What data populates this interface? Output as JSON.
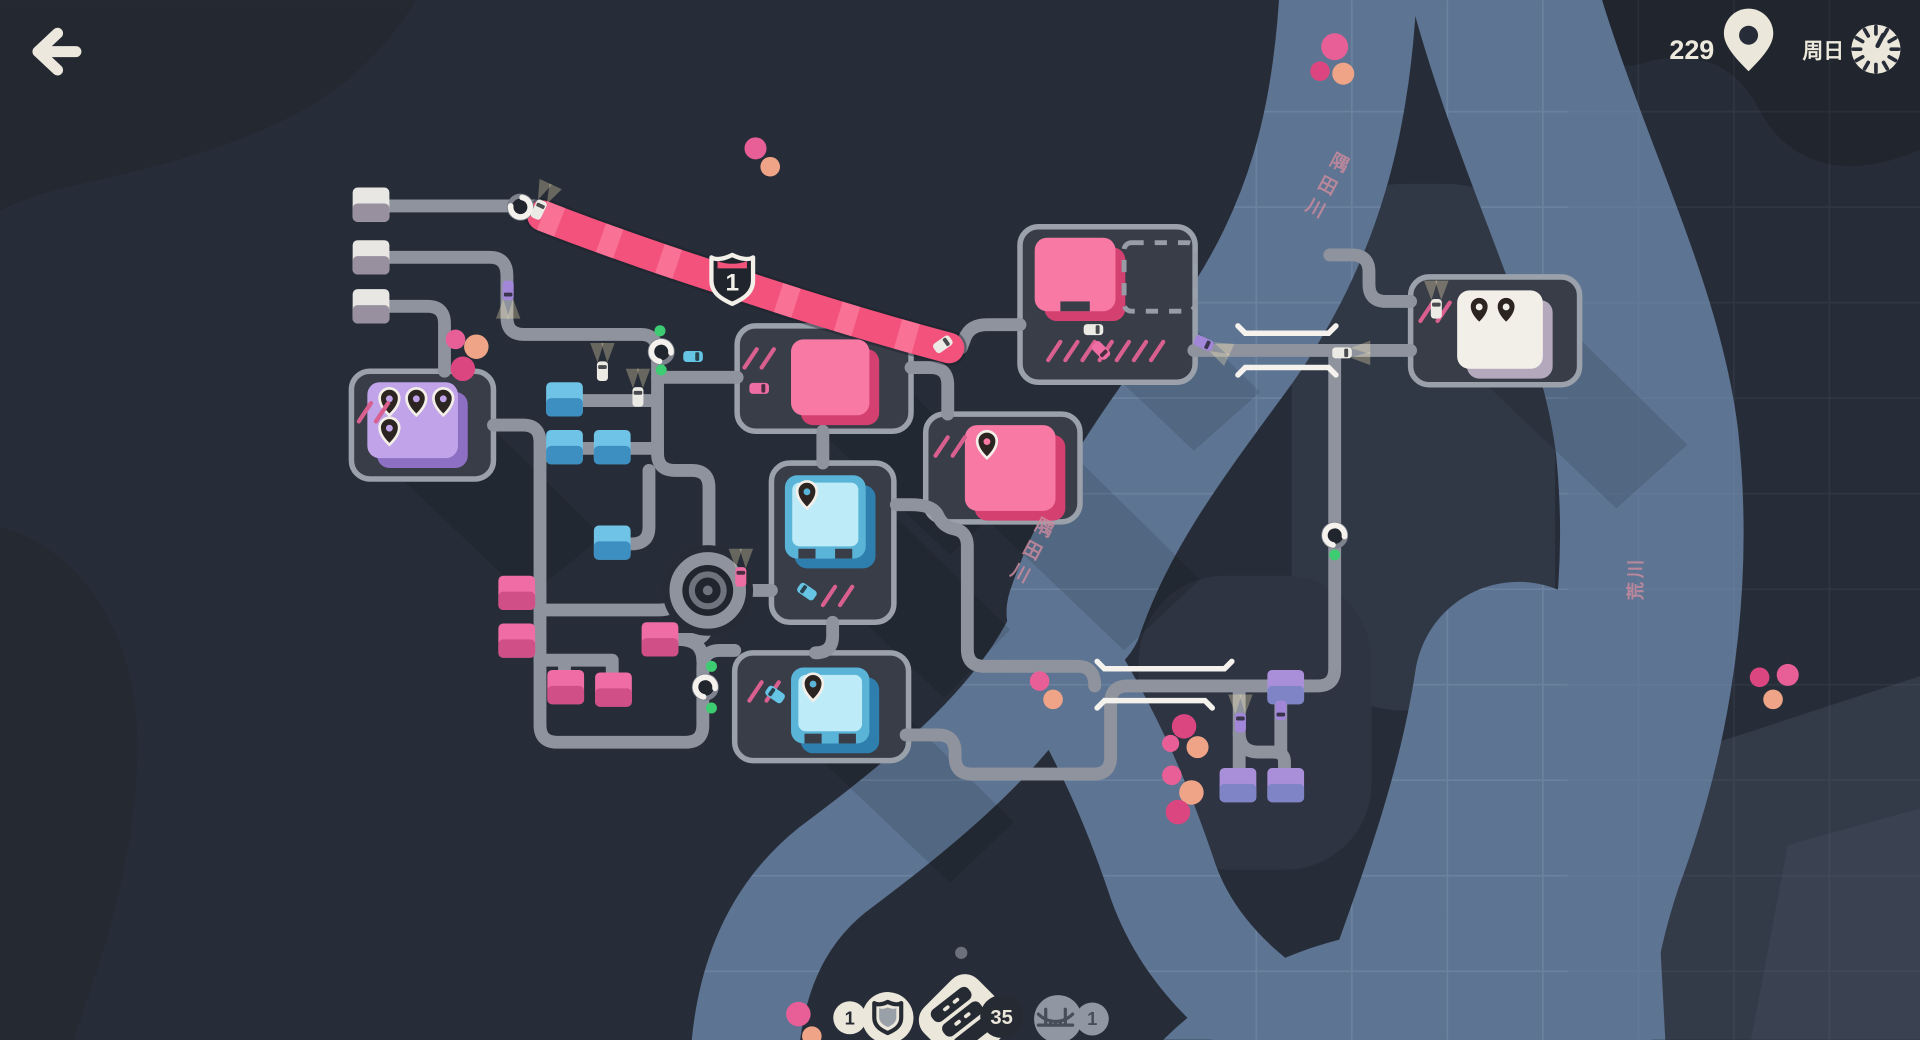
{
  "hud": {
    "back_label": "back",
    "score": "229",
    "day_label": "周日",
    "resources": {
      "motorways": {
        "count": "1",
        "icon": "motorway-shield-icon"
      },
      "road_tiles": {
        "count": "35",
        "icon": "road-tile-stack-icon"
      },
      "bridges": {
        "count": "1",
        "icon": "bridge-icon",
        "state": "disabled"
      }
    }
  },
  "map": {
    "motorway_badge": {
      "number": "1"
    },
    "river_labels": [
      {
        "text": "隅田川",
        "x": 1093,
        "y": 138,
        "rot": 28
      },
      {
        "text": "隅田川",
        "x": 852,
        "y": 436,
        "rot": 28
      },
      {
        "text": "荒川",
        "x": 1341,
        "y": 472,
        "rot": -90
      }
    ],
    "colors": {
      "road": "#8e939d",
      "pad": "#383d48",
      "pad_border": "#9aa1ab",
      "river": "#5d7492",
      "motorway": "#f2527c",
      "cream": "#ece8dc",
      "green_light": "#3ecc72"
    },
    "houses": [
      {
        "color": "white",
        "x": 288,
        "y": 153
      },
      {
        "color": "white",
        "x": 288,
        "y": 196
      },
      {
        "color": "white",
        "x": 288,
        "y": 236
      },
      {
        "color": "cyan",
        "x": 446,
        "y": 312
      },
      {
        "color": "cyan",
        "x": 446,
        "y": 351
      },
      {
        "color": "cyan",
        "x": 485,
        "y": 351
      },
      {
        "color": "cyan",
        "x": 485,
        "y": 429
      },
      {
        "color": "pink",
        "x": 407,
        "y": 470
      },
      {
        "color": "pink",
        "x": 407,
        "y": 509
      },
      {
        "color": "pink",
        "x": 447,
        "y": 547
      },
      {
        "color": "pink",
        "x": 486,
        "y": 549
      },
      {
        "color": "pink",
        "x": 524,
        "y": 508
      },
      {
        "color": "purple",
        "x": 1035,
        "y": 547
      },
      {
        "color": "purple",
        "x": 996,
        "y": 627
      },
      {
        "color": "purple",
        "x": 1035,
        "y": 627
      }
    ],
    "destinations": [
      {
        "color": "purple",
        "x": 300,
        "y": 312,
        "w": 74,
        "h": 62,
        "pins": 4,
        "pad": [
          287,
          303,
          116,
          88
        ],
        "slashes": [
          293,
          344,
          2
        ]
      },
      {
        "color": "pink",
        "x": 845,
        "y": 194,
        "w": 66,
        "h": 60,
        "pins": 0,
        "pad": [
          833,
          185,
          143,
          127
        ],
        "door": 1,
        "dashed": [
          918,
          198,
          58,
          56
        ],
        "slashes": [
          856,
          294,
          7
        ]
      },
      {
        "color": "pink",
        "x": 646,
        "y": 277,
        "w": 64,
        "h": 62,
        "pins": 0,
        "pad": [
          602,
          266,
          142,
          86
        ],
        "slashes": [
          608,
          300,
          2
        ]
      },
      {
        "color": "pink",
        "x": 788,
        "y": 347,
        "w": 74,
        "h": 70,
        "pins": 1,
        "pad": [
          756,
          338,
          126,
          88
        ],
        "slashes": [
          764,
          372,
          2
        ]
      },
      {
        "color": "cyan",
        "x": 641,
        "y": 388,
        "w": 66,
        "h": 68,
        "pins": 1,
        "pad": [
          630,
          378,
          100,
          130
        ],
        "door": 2,
        "slashes": [
          672,
          494,
          2
        ]
      },
      {
        "color": "cyan",
        "x": 646,
        "y": 545,
        "w": 64,
        "h": 62,
        "pins": 1,
        "pad": [
          600,
          533,
          142,
          88
        ],
        "door": 2,
        "slashes": [
          612,
          572,
          2
        ]
      },
      {
        "color": "white",
        "x": 1190,
        "y": 237,
        "w": 70,
        "h": 64,
        "pins": 2,
        "pad": [
          1152,
          226,
          138,
          88
        ],
        "slashes": [
          1160,
          262,
          2
        ]
      }
    ],
    "cars": [
      {
        "color": "white",
        "x": 440,
        "y": 171,
        "rot": 25,
        "lights": true
      },
      {
        "color": "purple",
        "x": 415,
        "y": 237,
        "rot": 180,
        "lights": true
      },
      {
        "color": "cyan",
        "x": 566,
        "y": 291,
        "rot": 90
      },
      {
        "color": "white",
        "x": 492,
        "y": 303,
        "rot": 0,
        "lights": true
      },
      {
        "color": "white",
        "x": 521,
        "y": 324,
        "rot": 0,
        "lights": true
      },
      {
        "color": "white",
        "x": 893,
        "y": 269,
        "rot": 90
      },
      {
        "color": "pink",
        "x": 899,
        "y": 286,
        "rot": 135
      },
      {
        "color": "purple",
        "x": 983,
        "y": 280,
        "rot": 115,
        "lights": true
      },
      {
        "color": "white",
        "x": 1096,
        "y": 288,
        "rot": 90,
        "lights": true
      },
      {
        "color": "white",
        "x": 1173,
        "y": 252,
        "rot": 0,
        "lights": true
      },
      {
        "color": "cyan",
        "x": 659,
        "y": 483,
        "rot": -55
      },
      {
        "color": "cyan",
        "x": 633,
        "y": 567,
        "rot": -55
      },
      {
        "color": "pink",
        "x": 620,
        "y": 317,
        "rot": 90
      },
      {
        "color": "pink",
        "x": 605,
        "y": 471,
        "rot": 0,
        "lights": true
      },
      {
        "color": "purple",
        "x": 1013,
        "y": 590,
        "rot": 0,
        "lights": true
      },
      {
        "color": "purple",
        "x": 1046,
        "y": 580,
        "rot": 180
      },
      {
        "color": "white",
        "x": 770,
        "y": 281,
        "rot": 55
      }
    ],
    "dots": [
      {
        "c": "#e85f98",
        "x": 1090,
        "y": 38,
        "r": 11
      },
      {
        "c": "#dc4680",
        "x": 1078,
        "y": 58,
        "r": 8
      },
      {
        "c": "#efa487",
        "x": 1097,
        "y": 60,
        "r": 9
      },
      {
        "c": "#e85f98",
        "x": 617,
        "y": 121,
        "r": 9
      },
      {
        "c": "#efa487",
        "x": 629,
        "y": 136,
        "r": 8
      },
      {
        "c": "#e85f98",
        "x": 372,
        "y": 277,
        "r": 8
      },
      {
        "c": "#efa487",
        "x": 389,
        "y": 283,
        "r": 10
      },
      {
        "c": "#dc4680",
        "x": 378,
        "y": 301,
        "r": 10
      },
      {
        "c": "#e85f98",
        "x": 849,
        "y": 556,
        "r": 8
      },
      {
        "c": "#efa487",
        "x": 860,
        "y": 571,
        "r": 8
      },
      {
        "c": "#dc4680",
        "x": 967,
        "y": 593,
        "r": 10
      },
      {
        "c": "#e85f98",
        "x": 956,
        "y": 607,
        "r": 7
      },
      {
        "c": "#efa487",
        "x": 978,
        "y": 610,
        "r": 9
      },
      {
        "c": "#e85f98",
        "x": 957,
        "y": 633,
        "r": 8
      },
      {
        "c": "#efa487",
        "x": 973,
        "y": 647,
        "r": 10
      },
      {
        "c": "#dc4680",
        "x": 962,
        "y": 663,
        "r": 10
      },
      {
        "c": "#dc4680",
        "x": 1437,
        "y": 553,
        "r": 8
      },
      {
        "c": "#e85f98",
        "x": 1460,
        "y": 551,
        "r": 9
      },
      {
        "c": "#efa487",
        "x": 1448,
        "y": 571,
        "r": 8
      },
      {
        "c": "#e85f98",
        "x": 652,
        "y": 828,
        "r": 10
      },
      {
        "c": "#efa487",
        "x": 663,
        "y": 846,
        "r": 8
      },
      {
        "c": "#6b707a",
        "x": 785,
        "y": 778,
        "r": 5
      }
    ],
    "traffic_lights": [
      {
        "x": 425,
        "y": 169,
        "rot": -80
      },
      {
        "x": 540,
        "y": 287,
        "rot": 100
      },
      {
        "x": 576,
        "y": 561,
        "rot": 100
      },
      {
        "x": 1090,
        "y": 437,
        "rot": 100
      }
    ],
    "signals": [
      [
        539,
        270
      ],
      [
        540,
        302
      ],
      [
        581,
        544
      ],
      [
        581,
        578
      ],
      [
        1090,
        453
      ]
    ]
  }
}
